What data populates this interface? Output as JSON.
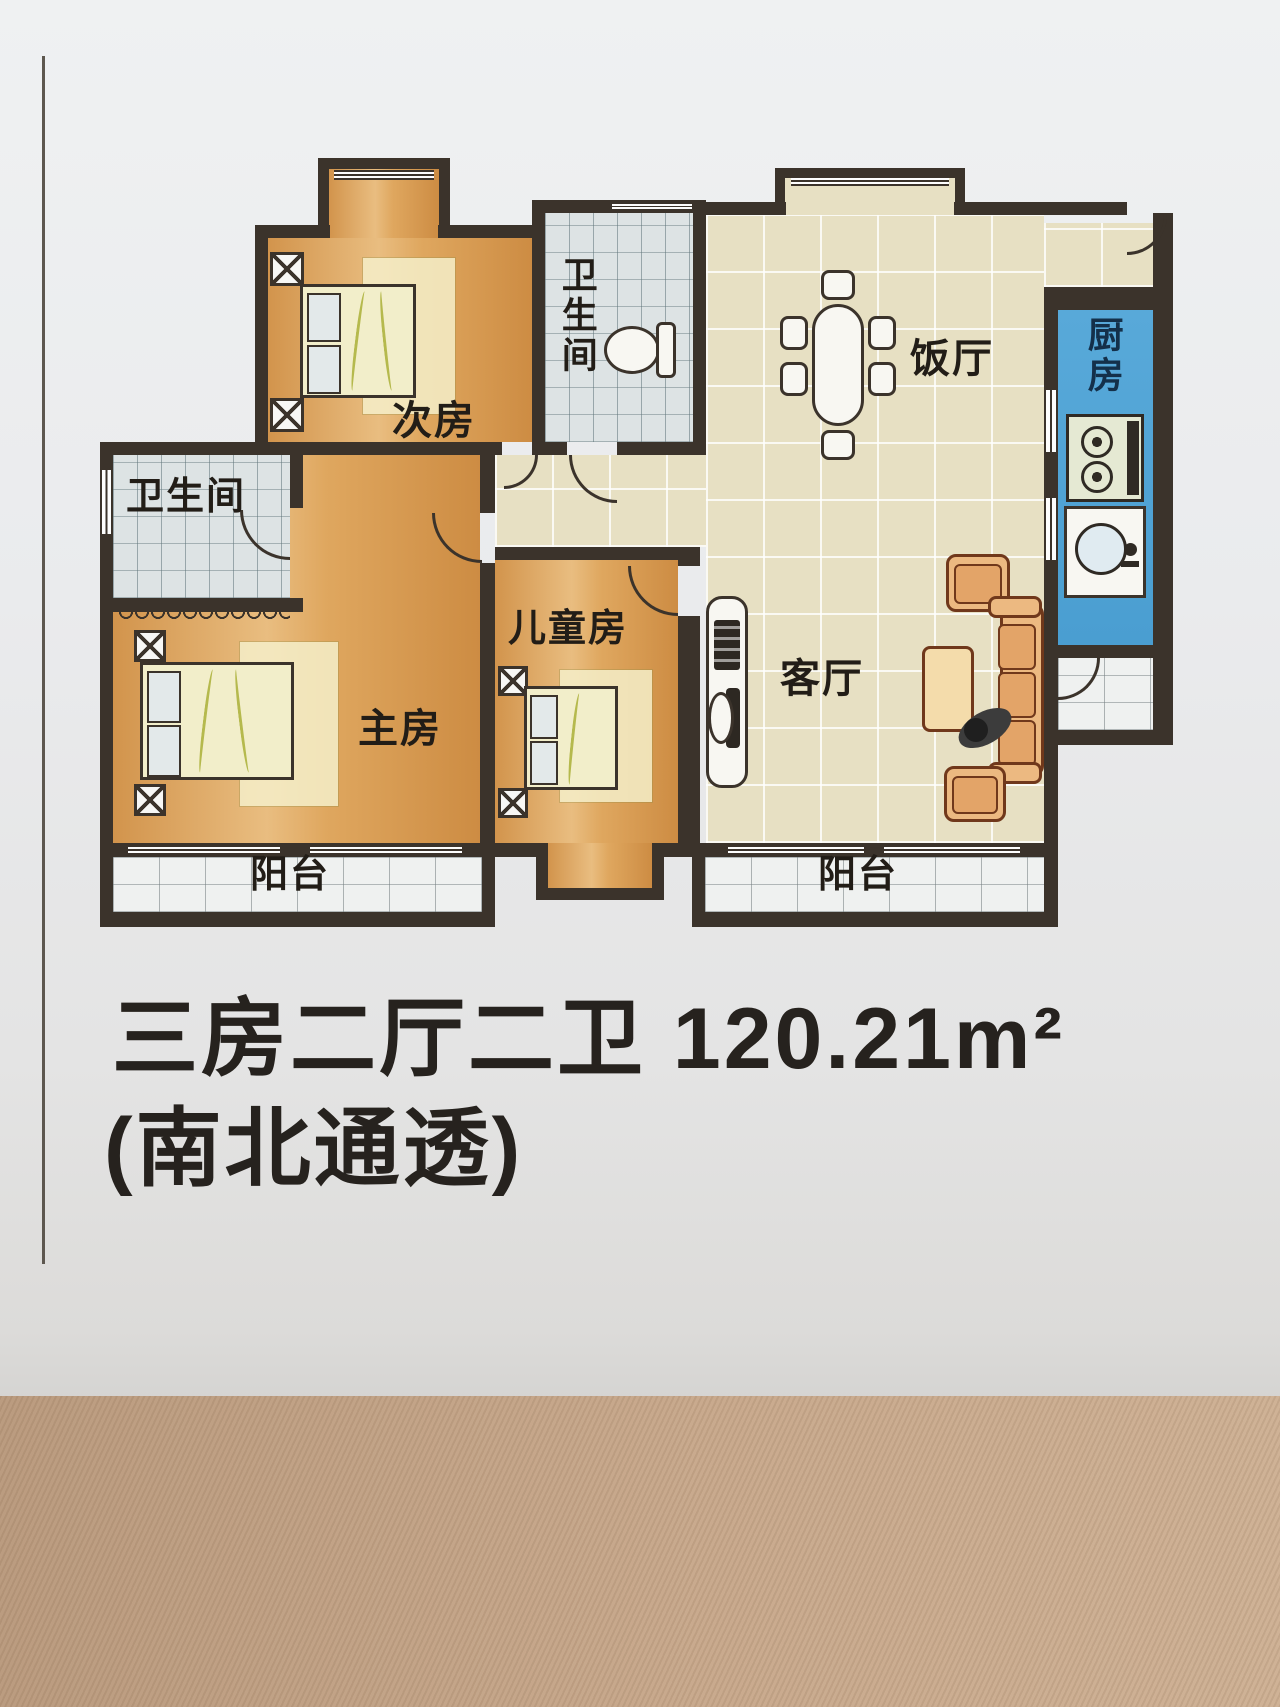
{
  "plan": {
    "rooms": {
      "secondary_bedroom": "次房",
      "bathroom_top": "卫生间",
      "dining_room": "饭厅",
      "kitchen": "厨房",
      "bathroom_left": "卫生间",
      "master_bedroom": "主房",
      "children_room": "儿童房",
      "living_room": "客厅",
      "balcony_left": "阳台",
      "balcony_right": "阳台"
    }
  },
  "caption": {
    "line1": "三房二厅二卫 120.21m²",
    "line2": "(南北通透)"
  },
  "colors": {
    "wall": "#3b332b",
    "kitchen_blue": "#54a8d8",
    "bedroom_orange": "#dca261",
    "public_beige": "#e7e0c3",
    "bath_tile": "#dde3e4",
    "balcony_tile": "#eff1f0",
    "paper": "#e9eaec",
    "photo_strip": "#c8a98c"
  }
}
